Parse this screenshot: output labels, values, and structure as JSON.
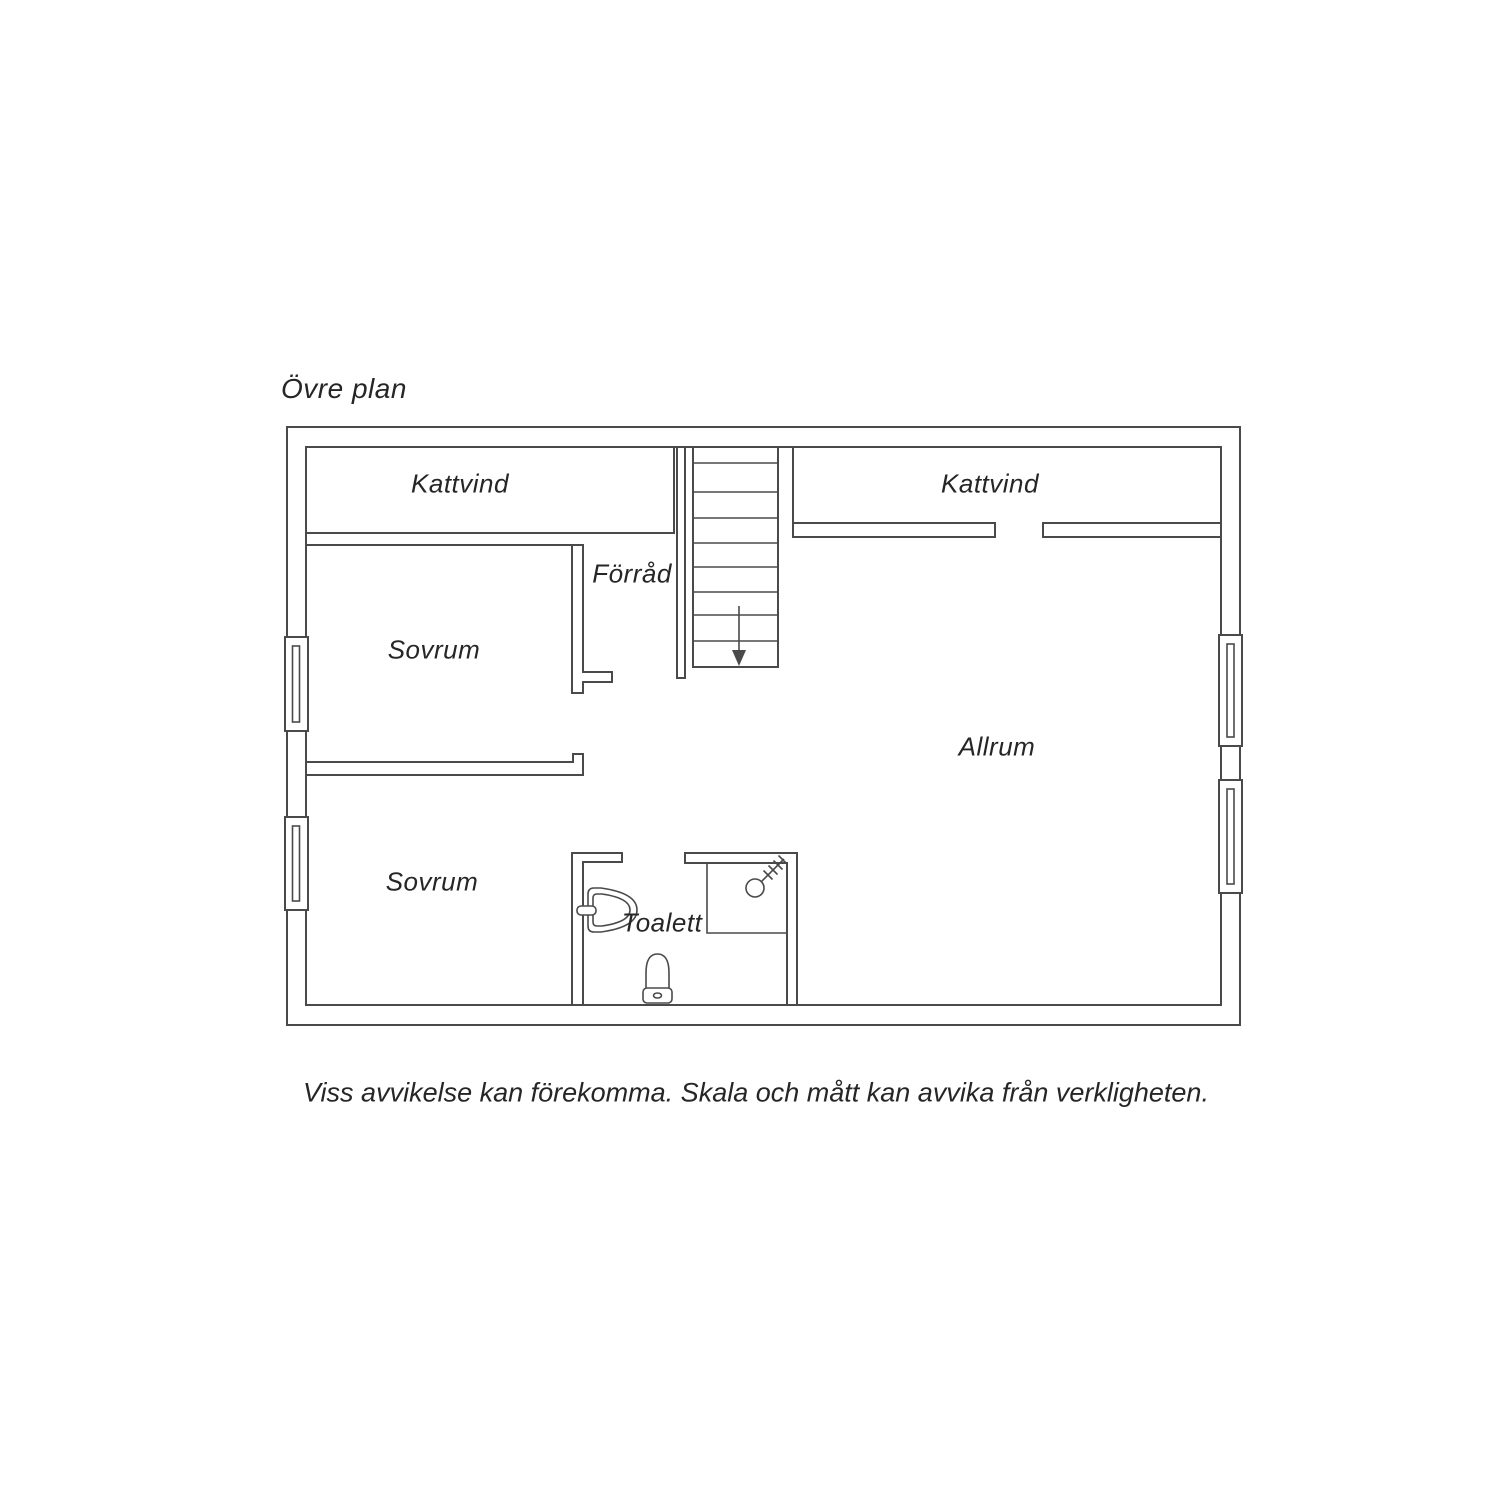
{
  "title": "Övre plan",
  "floorplan": {
    "rooms": [
      {
        "id": "kattvind-left",
        "label": "Kattvind"
      },
      {
        "id": "forrad",
        "label": "Förråd"
      },
      {
        "id": "sovrum-upper",
        "label": "Sovrum"
      },
      {
        "id": "kattvind-right",
        "label": "Kattvind"
      },
      {
        "id": "allrum",
        "label": "Allrum"
      },
      {
        "id": "sovrum-lower",
        "label": "Sovrum"
      },
      {
        "id": "toalett",
        "label": "Toalett"
      }
    ],
    "stairs": {
      "direction": "down",
      "symbol": "down-arrow"
    },
    "fixtures": [
      "toilet",
      "sink",
      "shower"
    ],
    "windows_count": 4
  },
  "footer": {
    "disclaimer": "Viss avvikelse kan förekomma. Skala och mått kan avvika från verkligheten."
  },
  "colors": {
    "wall_line": "#4a4a4a",
    "label_text": "#262626",
    "background": "#ffffff"
  }
}
